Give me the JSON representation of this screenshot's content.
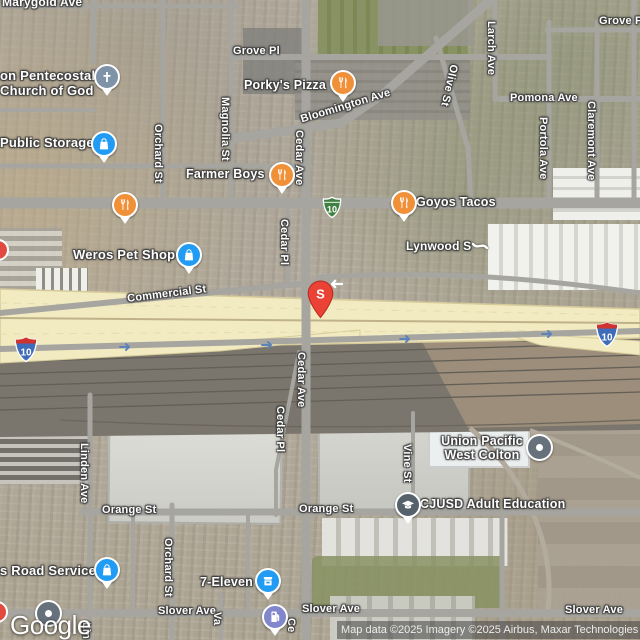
{
  "brand": {
    "logo_text": "Google"
  },
  "attribution": {
    "text": "Map data ©2025 Imagery ©2025 Airbus, Maxar Technologies"
  },
  "marker": {
    "letter": "S"
  },
  "shields": {
    "interstate_label": "10",
    "business_label": "10"
  },
  "street_labels": {
    "marygold": "Marygold Ave",
    "grove_pl": "Grove Pl",
    "pomona": "Pomona Ave",
    "bloomington": "Bloomington Ave",
    "olive": "Olive St",
    "larch": "Larch Ave",
    "portola": "Portola Ave",
    "claremont": "Claremont Ave",
    "magnolia": "Magnolia St",
    "orchard": "Orchard St",
    "cedar_ave": "Cedar Ave",
    "cedar_pl": "Cedar Pl",
    "commercial": "Commercial St",
    "lynwood": "Lynwood S",
    "orange": "Orange St",
    "slover": "Slover Ave",
    "linden": "Linden Ave",
    "vine": "Vine St",
    "partial_va": "Va",
    "partial_lin": "Lin",
    "partial_ce": "Ce"
  },
  "pois": {
    "church_line1": "on Pentecostal",
    "church_line2": "Church of God",
    "public_storage": "Public Storage",
    "porkys": "Porky's Pizza",
    "farmer_boys": "Farmer Boys",
    "goyos": "Goyos Tacos",
    "weros": "Weros Pet Shop",
    "union_pacific_line1": "Union Pacific",
    "union_pacific_line2": "West Colton",
    "cjusd": "CJUSD Adult Education",
    "seven_eleven": "7-Eleven",
    "road_service": "s Road Service"
  },
  "icons": {
    "restaurant": "fork-knife-icon",
    "shopping": "shopping-bag-icon",
    "convenience": "storefront-icon",
    "church": "cross-icon",
    "school": "graduation-cap-icon",
    "gas": "gas-pump-icon",
    "business": "dot-icon",
    "marker": "teardrop-pin"
  },
  "colors": {
    "pin_red": "#EA4335",
    "pin_orange": "#F0913A",
    "pin_blue": "#219BF3",
    "pin_slate": "#57616B",
    "pin_gray_blue": "#7E93A7",
    "pin_gas_purple": "#8286CB",
    "shield_blue": "#3E6CB8",
    "shield_red": "#CE3330",
    "shield_green": "#3F8142",
    "freeway_yellow": "#F2EAC0"
  }
}
